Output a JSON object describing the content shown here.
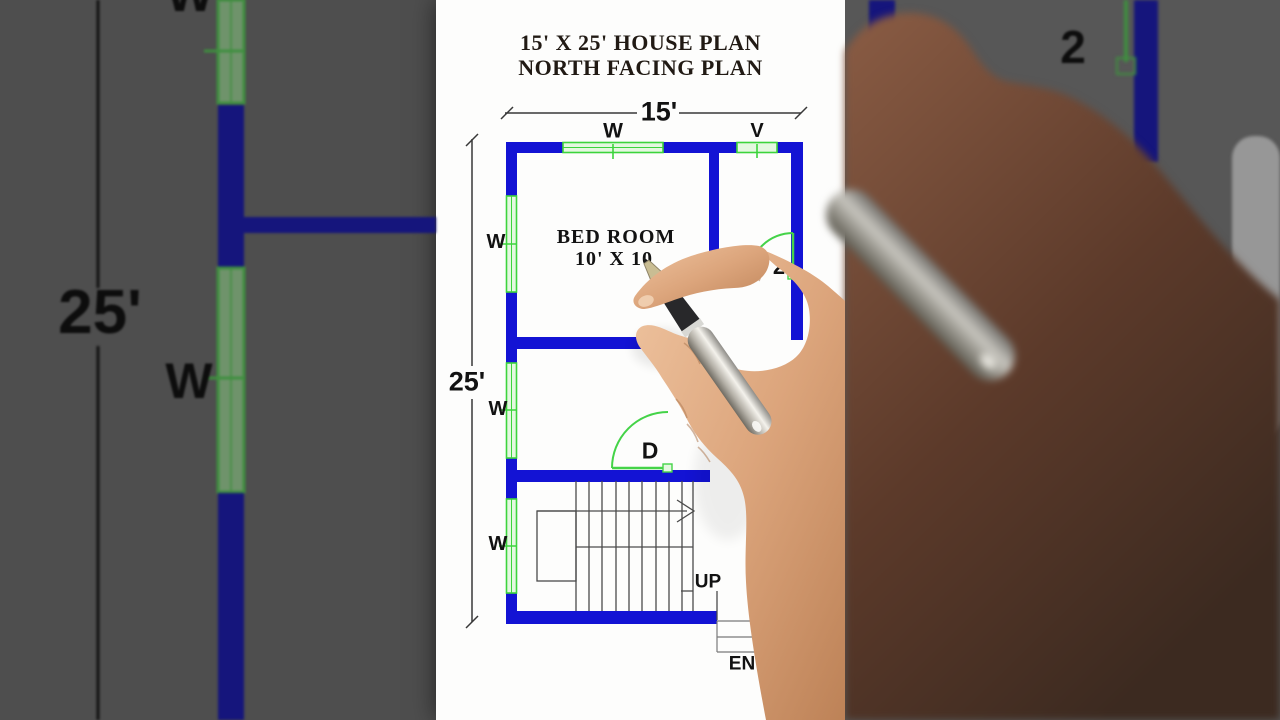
{
  "header": {
    "title_line1": "15' X 25' HOUSE PLAN",
    "title_line2": "NORTH FACING PLAN"
  },
  "dimensions": {
    "width_label": "15'",
    "height_label": "25'"
  },
  "rooms": {
    "bedroom_name": "BED ROOM",
    "bedroom_size": "10' X 10"
  },
  "labels": {
    "window": "W",
    "ventilator": "V",
    "door": "D",
    "door2_partial": "2",
    "stairs_up": "UP",
    "entry_partial": "EN"
  },
  "background_left": {
    "dim_label": "25'",
    "window_label": "W",
    "window_label_top": "W"
  },
  "background_right": {
    "door2_partial": "2"
  },
  "colors": {
    "wall_blue": "#1313d4",
    "wall_navy_bg": "#15157c",
    "window_green": "#3cd43c",
    "window_fill": "#e4f8e0",
    "door_green": "#44d348",
    "stair_line": "#4b4b4b",
    "dimension_line": "#383838",
    "title_text": "#211a14",
    "panel_left_bg": "#4e4e4e",
    "panel_right_bg": "#575757",
    "skin_tone": "#d9a178",
    "pen_silver": "#f0eee8"
  }
}
